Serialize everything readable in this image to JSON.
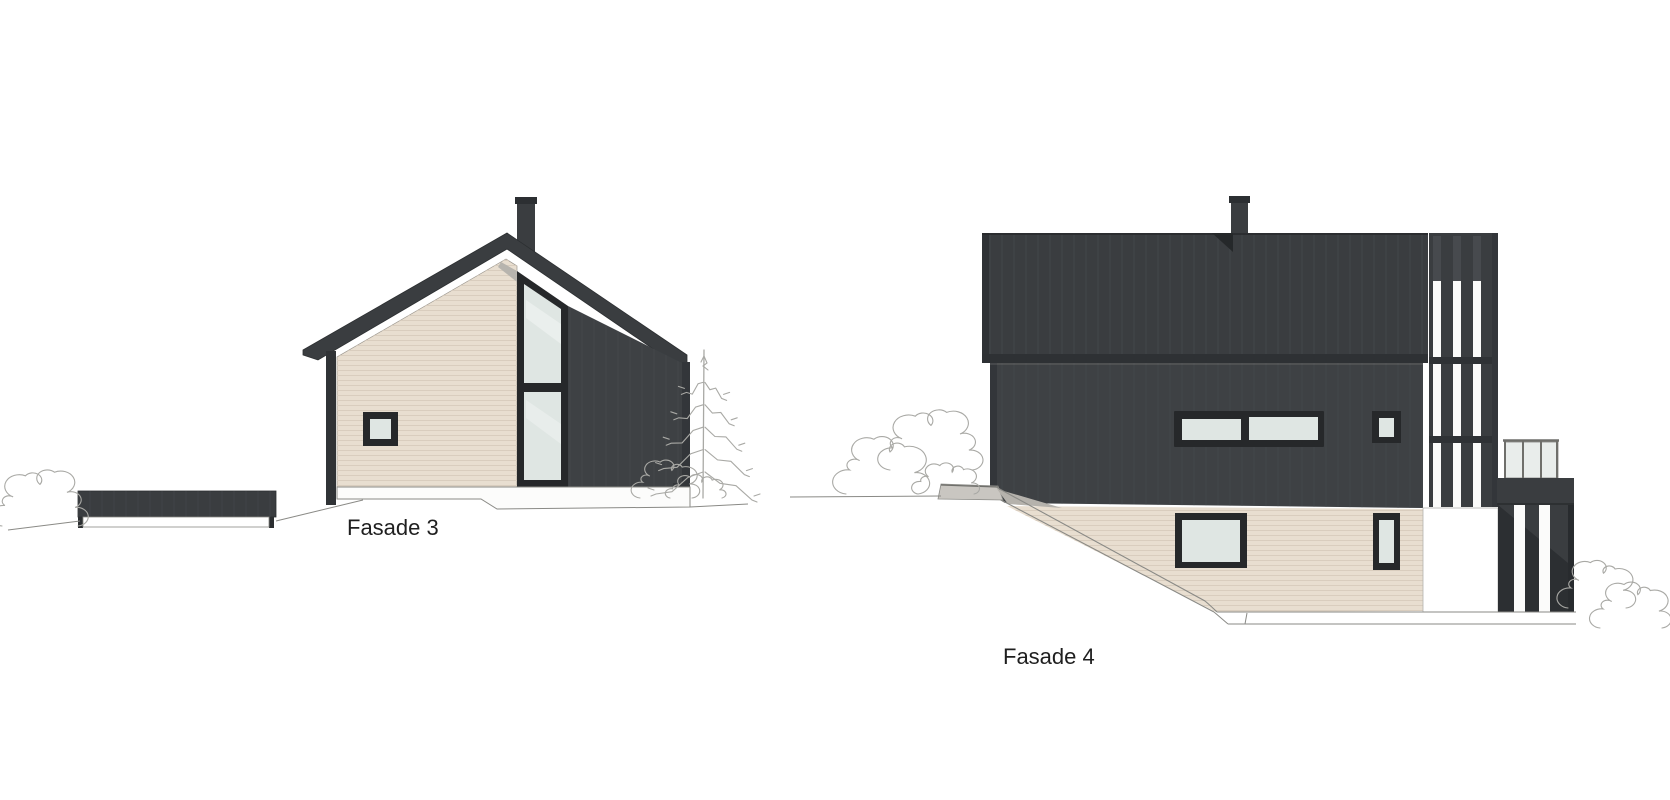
{
  "sheet": {
    "kind": "architectural-elevation-drawings",
    "background": "#ffffff"
  },
  "labels": {
    "fasade3": "Fasade 3",
    "fasade4": "Fasade 4"
  },
  "colors": {
    "cladding_dark": "#3a3d40",
    "cladding_dark_wall": "#3e4144",
    "cladding_trim": "#303336",
    "board_line": "#474a4e",
    "siding_beige": "#e8ded0",
    "siding_line": "#d9cdbe",
    "window_frame": "#26282a",
    "glass": "#dfe6e3",
    "railing_glass": "#e9edeb",
    "outline": "#8a8a86",
    "sketch": "#a9a9a5",
    "concrete": "#c9c6c1",
    "label_text": "#1f1f1f"
  },
  "decor": {
    "bushes": [
      {
        "x": 2,
        "y": 470,
        "w": 76,
        "h": 56
      },
      {
        "x": 640,
        "y": 460,
        "w": 52,
        "h": 38
      },
      {
        "x": 846,
        "y": 436,
        "w": 72,
        "h": 58
      },
      {
        "x": 890,
        "y": 410,
        "w": 82,
        "h": 60
      },
      {
        "x": 918,
        "y": 464,
        "w": 56,
        "h": 30
      },
      {
        "x": 1568,
        "y": 560,
        "w": 58,
        "h": 48
      },
      {
        "x": 1600,
        "y": 582,
        "w": 62,
        "h": 46
      }
    ],
    "trees": [
      {
        "x": 656,
        "y": 346,
        "w": 96,
        "h": 152
      }
    ]
  }
}
